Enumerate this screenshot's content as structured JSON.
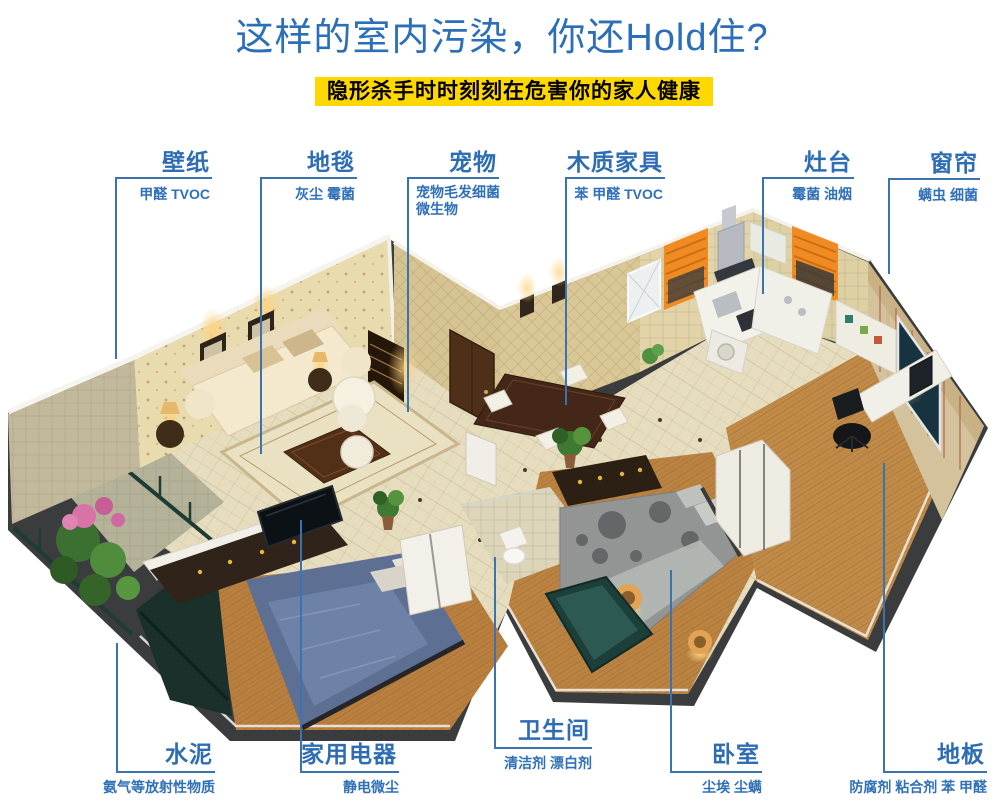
{
  "header": {
    "title": "这样的室内污染，你还Hold住?",
    "subtitle": "隐形杀手时时刻刻在危害你的家人健康"
  },
  "colors": {
    "title_blue": "#2b6fb8",
    "label_blue": "#2e6db4",
    "pollutant_blue": "#2f70b8",
    "line_blue": "#3b73ae",
    "banner_bg": "#ffd800",
    "banner_text": "#000000"
  },
  "callouts": {
    "top": [
      {
        "id": "wallpaper",
        "label": "壁纸",
        "pollutants": "甲醛 TVOC"
      },
      {
        "id": "carpet",
        "label": "地毯",
        "pollutants": "灰尘 霉菌"
      },
      {
        "id": "pet",
        "label": "宠物",
        "pollutants": "宠物毛发细菌 微生物"
      },
      {
        "id": "wood-furniture",
        "label": "木质家具",
        "pollutants": "苯 甲醛 TVOC"
      },
      {
        "id": "stove",
        "label": "灶台",
        "pollutants": "霉菌 油烟"
      },
      {
        "id": "curtain",
        "label": "窗帘",
        "pollutants": "螨虫 细菌"
      }
    ],
    "bottom": [
      {
        "id": "cement",
        "label": "水泥",
        "pollutants": "氨气等放射性物质"
      },
      {
        "id": "appliance",
        "label": "家用电器",
        "pollutants": "静电微尘"
      },
      {
        "id": "bathroom",
        "label": "卫生间",
        "pollutants": "清洁剂 漂白剂"
      },
      {
        "id": "bedroom",
        "label": "卧室",
        "pollutants": "尘埃 尘螨"
      },
      {
        "id": "floor",
        "label": "地板",
        "pollutants": "防腐剂 粘合剂 苯 甲醛"
      }
    ]
  }
}
